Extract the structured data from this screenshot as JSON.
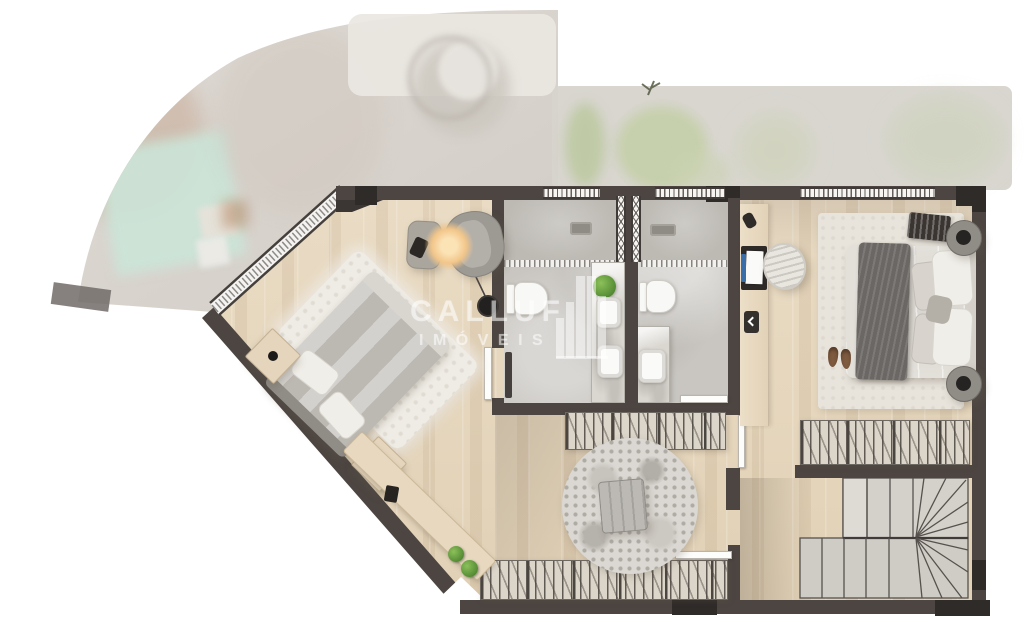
{
  "watermark": {
    "brand": "CALLUF",
    "subtitle": "IMÓVEIS"
  },
  "palette": {
    "wall": "#4c4541",
    "wall_dark": "#2f2b29",
    "wood": "#e7d9c1",
    "bath_floor": "#c9c6c1",
    "shower_floor": "#bdbab4",
    "marble": "#dad7d1",
    "closet_base": "#dcd6ca",
    "white_rug": "#efece5",
    "bed_gray": "#bcb8b2",
    "throw_dark": "#6b6764",
    "master_duvet": "#e3e0da",
    "stair": "#d2cfc9",
    "lamp_glow": "#f2c68a",
    "plant_green": "#6fae3e",
    "pool_teal": "#cbe5d8",
    "ghost_gray": "#d6d1ca",
    "watermark": "rgba(255,255,255,0.52)"
  }
}
